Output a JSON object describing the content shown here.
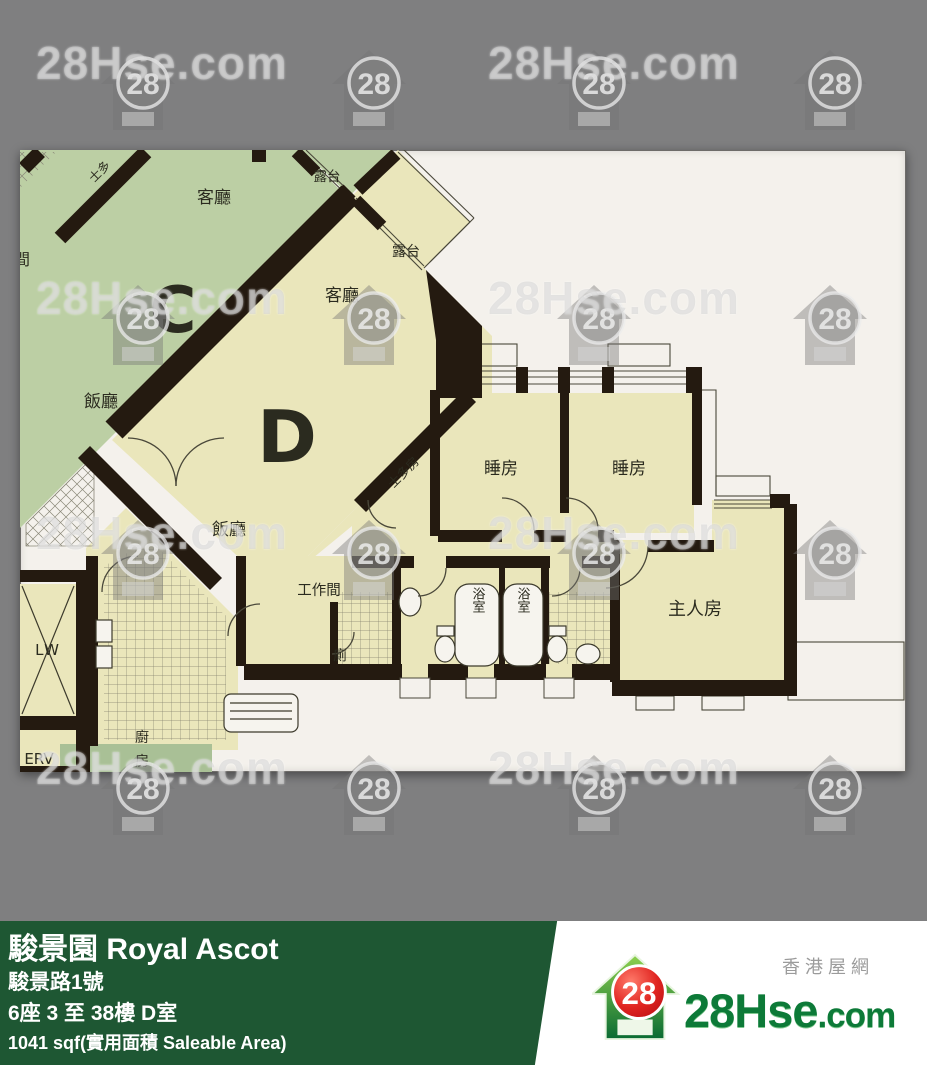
{
  "watermark": {
    "text": "28Hse.com",
    "badge": "28"
  },
  "plan": {
    "labels": {
      "unit_c": "C",
      "unit_d": "D",
      "c_living": "客廳",
      "c_balcony": "露台",
      "c_dining": "飯廳",
      "c_storage": "士多",
      "c_partial": "間",
      "d_living": "客廳",
      "d_balcony": "露台",
      "d_dining": "飯廳",
      "storeroom": "士多房",
      "bed1": "睡房",
      "bed2": "睡房",
      "master": "主人房",
      "workroom": "工作間",
      "toilet": "廁",
      "bath1": "浴室",
      "bath2": "浴室",
      "kitchen": "廚",
      "kitchen2": "房",
      "lift": "LW",
      "service": "ERV"
    }
  },
  "footer": {
    "title": "駿景園 Royal Ascot",
    "address": "駿景路1號",
    "block_floor_unit": "6座 3 至 38樓 D室",
    "area": "1041 sqf(實用面積 Saleable Area)"
  },
  "logo": {
    "badge": "28",
    "name": "28Hse",
    "tld": ".com",
    "tagline": "香港屋網"
  },
  "colors": {
    "background": "#7f7f80",
    "bar_green": "#1e5733",
    "unit_c": "#bccfa4",
    "unit_d": "#eae6bb",
    "wall": "#241a10",
    "logo_green": "#0d7a38",
    "logo_red": "#d6232a"
  }
}
